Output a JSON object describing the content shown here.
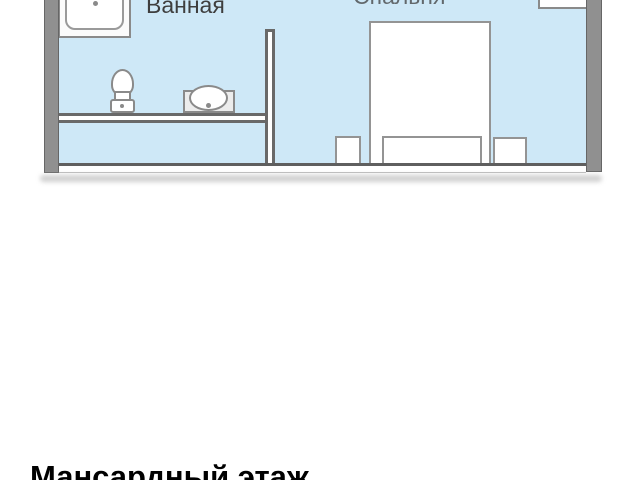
{
  "plan": {
    "bathroom_label": "Ванная",
    "bedroom_label": "Спальня",
    "title": "Мансардный этаж",
    "fixtures": [
      "sink",
      "toilet",
      "washbasin",
      "bed",
      "nightstand-left",
      "nightstand-right",
      "window-niche"
    ],
    "colors": {
      "room_fill": "#cee8f7",
      "wall_gray": "#909090",
      "fixture_outline": "#8a8a8a",
      "label_color": "#3e3e3e",
      "title_color": "#000000"
    }
  }
}
